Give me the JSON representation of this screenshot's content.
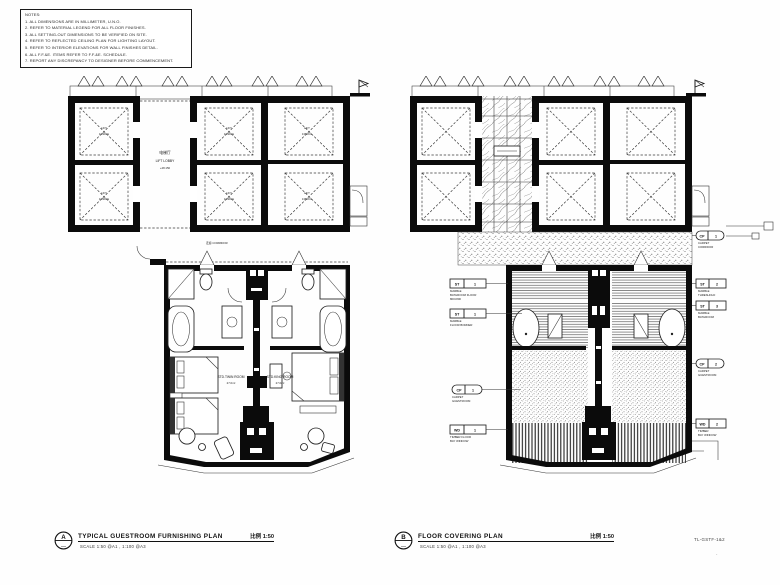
{
  "sheet": {
    "bg": "#fefefe",
    "ink": "#111111"
  },
  "notes": {
    "lines": [
      "NOTES:",
      "1. ALL DIMENSIONS ARE IN MILLIMETER, U.N.O.",
      "2. REFER TO MATERIAL LEGEND FOR ALL FLOOR FINISHES.",
      "3. ALL SETTING-OUT DIMENSIONS TO BE VERIFIED ON SITE.",
      "4. REFER TO REFLECTED CEILING PLAN FOR LIGHTING LAYOUT.",
      "5. REFER TO INTERIOR ELEVATIONS FOR WALL FINISHES DETAIL.",
      "6. ALL F.F.&E. ITEMS REFER TO F.F.&E. SCHEDULE.",
      "7. REPORT ANY DISCREPANCY TO DESIGNER BEFORE COMMENCEMENT."
    ]
  },
  "plan_a": {
    "lobby_line1": "电梯厅",
    "lobby_line2": "LIFT LOBBY",
    "lobby_line3": "+48.150",
    "corridor_label": "走廊 CORRIDOR",
    "twin_room_line1": "STD.TWIN ROOM",
    "twin_room_line2": "27.0m²",
    "king_room_line1": "STD.KING ROOM",
    "king_room_line2": "27.0m²",
    "shaft_line1": "LIFT",
    "shaft_line2": "1350KG"
  },
  "plan_b": {
    "tags": {
      "l1": {
        "code": "ST",
        "num": "1",
        "d1": "MARBLE",
        "d2": "BATHROOM FLOOR",
        "d3": "800×800"
      },
      "l2": {
        "code": "ST",
        "num": "1",
        "d1": "MARBLE",
        "d2": "FLOOR BORDER"
      },
      "l3": {
        "code": "CP",
        "num": "1",
        "d1": "CARPET",
        "d2": "GUESTROOM"
      },
      "l4": {
        "code": "WD",
        "num": "1",
        "d1": "TIMBER FLOOR",
        "d2": "BAY WINDOW"
      },
      "r1": {
        "code": "CP",
        "num": "1",
        "d1": "CARPET",
        "d2": "CORRIDOR"
      },
      "r2": {
        "code": "ST",
        "num": "2",
        "d1": "MARBLE",
        "d2": "THRESHOLD"
      },
      "r3": {
        "code": "ST",
        "num": "3",
        "d1": "MARBLE",
        "d2": "BATHROOM"
      },
      "r4": {
        "code": "CP",
        "num": "2",
        "d1": "CARPET",
        "d2": "GUESTROOM"
      },
      "r5": {
        "code": "WD",
        "num": "2",
        "d1": "TIMBER",
        "d2": "BAY WINDOW"
      }
    }
  },
  "titles": {
    "a": {
      "bubble": "A",
      "bubble_sub": "—",
      "label": "TYPICAL GUESTROOM FURNISHING PLAN",
      "scale": "比例 1:50",
      "sub": "SCALE 1:50 @A1 , 1:100 @A3"
    },
    "b": {
      "bubble": "B",
      "bubble_sub": "—",
      "label": "FLOOR COVERING PLAN",
      "scale": "比例 1:50",
      "sub": "SCALE 1:50 @A1 , 1:100 @A3"
    }
  },
  "drawing_no": "TL-GSTF-1&2",
  "drawing_mark": "·"
}
